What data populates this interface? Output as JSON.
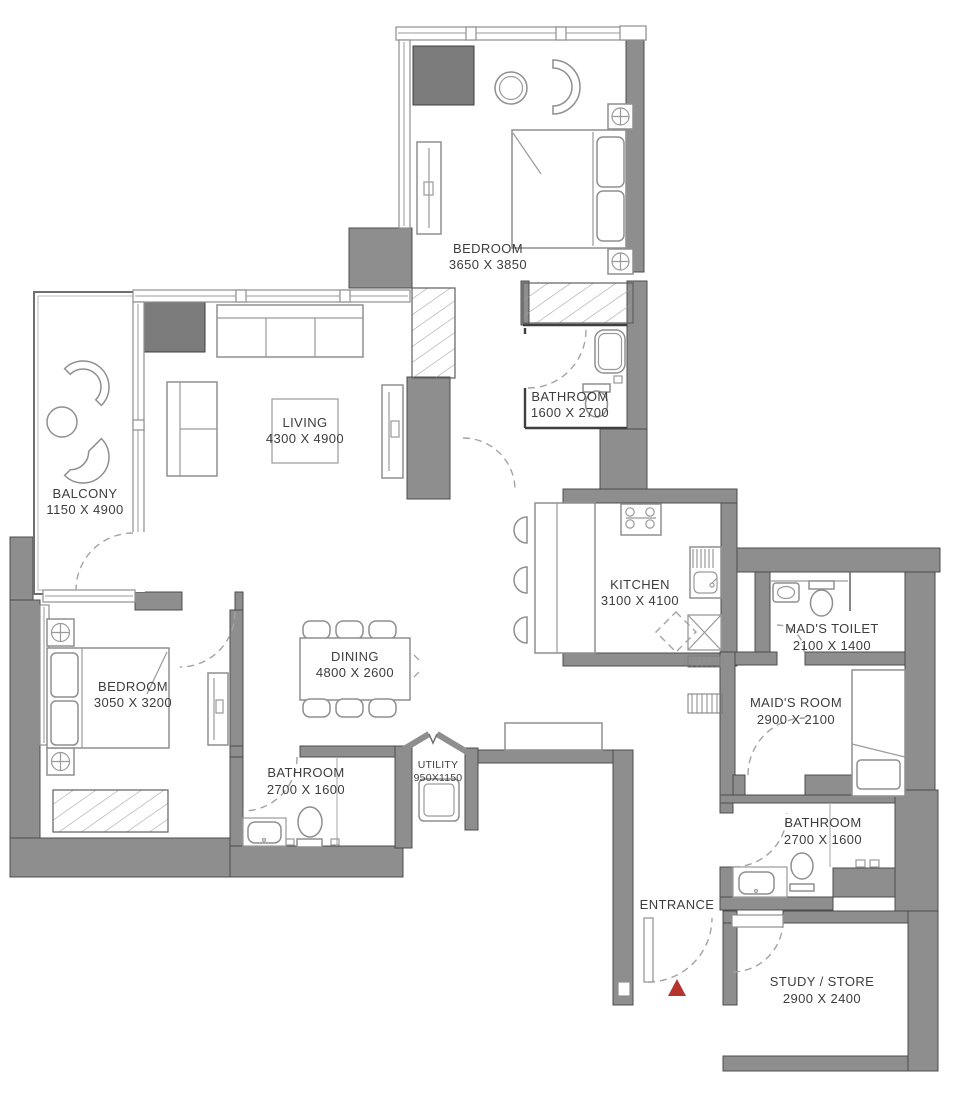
{
  "rooms": {
    "bedroom_top": {
      "name": "BEDROOM",
      "dims": "3650 X 3850"
    },
    "bathroom_top": {
      "name": "BATHROOM",
      "dims": "1600 X 2700"
    },
    "living": {
      "name": "LIVING",
      "dims": "4300 X 4900"
    },
    "balcony": {
      "name": "BALCONY",
      "dims": "1150 X 4900"
    },
    "kitchen": {
      "name": "KITCHEN",
      "dims": "3100 X 4100"
    },
    "maids_toilet": {
      "name": "MAD'S TOILET",
      "dims": "2100 X 1400"
    },
    "maids_room": {
      "name": "MAID'S ROOM",
      "dims": "2900 X 2100"
    },
    "bedroom_second": {
      "name": "BEDROOM",
      "dims": "3050 X 3200"
    },
    "dining": {
      "name": "DINING",
      "dims": "4800 X 2600"
    },
    "bathroom_left": {
      "name": "BATHROOM",
      "dims": "2700 X 1600"
    },
    "utility": {
      "name": "UTILITY",
      "dims": "950X1150"
    },
    "bathroom_right": {
      "name": "BATHROOM",
      "dims": "2700 X 1600"
    },
    "entrance": {
      "name": "ENTRANCE"
    },
    "study": {
      "name": "STUDY / STORE",
      "dims": "2900 X 2400"
    }
  },
  "colors": {
    "wall": "#8e8e8e",
    "wall_dark": "#7b7b7b",
    "wall_edge": "#4c4c4c",
    "text": "#3d3d3d",
    "entrance_marker": "#b5342e"
  }
}
